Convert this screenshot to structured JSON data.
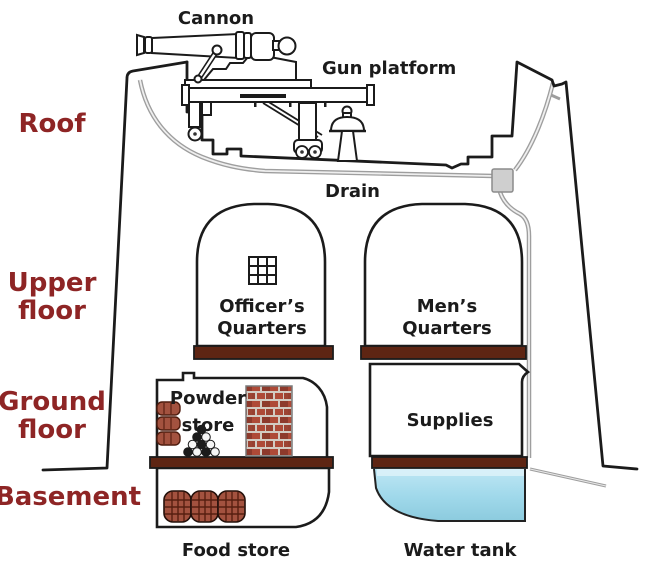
{
  "palette": {
    "section_label_red": "#8e2525",
    "outline_black": "#1b1b1b",
    "floor_slab_brown": "#5e2513",
    "barrel_red_brown": "#a3523f",
    "brick_red": "#ae4a37",
    "water_blue": "#a9dcee",
    "drain_grey": "#9e9e9e"
  },
  "section_labels": {
    "roof": "Roof",
    "upper_floor": [
      "Upper",
      "floor"
    ],
    "ground_floor": [
      "Ground",
      "floor"
    ],
    "basement": "Basement"
  },
  "part_labels": {
    "cannon": "Cannon",
    "gun_platform": "Gun platform",
    "drain": "Drain",
    "officers_quarters": [
      "Officer’s",
      "Quarters"
    ],
    "mens_quarters": [
      "Men’s",
      "Quarters"
    ],
    "powder_store": [
      "Powder",
      "store"
    ],
    "supplies": "Supplies",
    "food_store": "Food store",
    "water_tank": "Water tank"
  }
}
